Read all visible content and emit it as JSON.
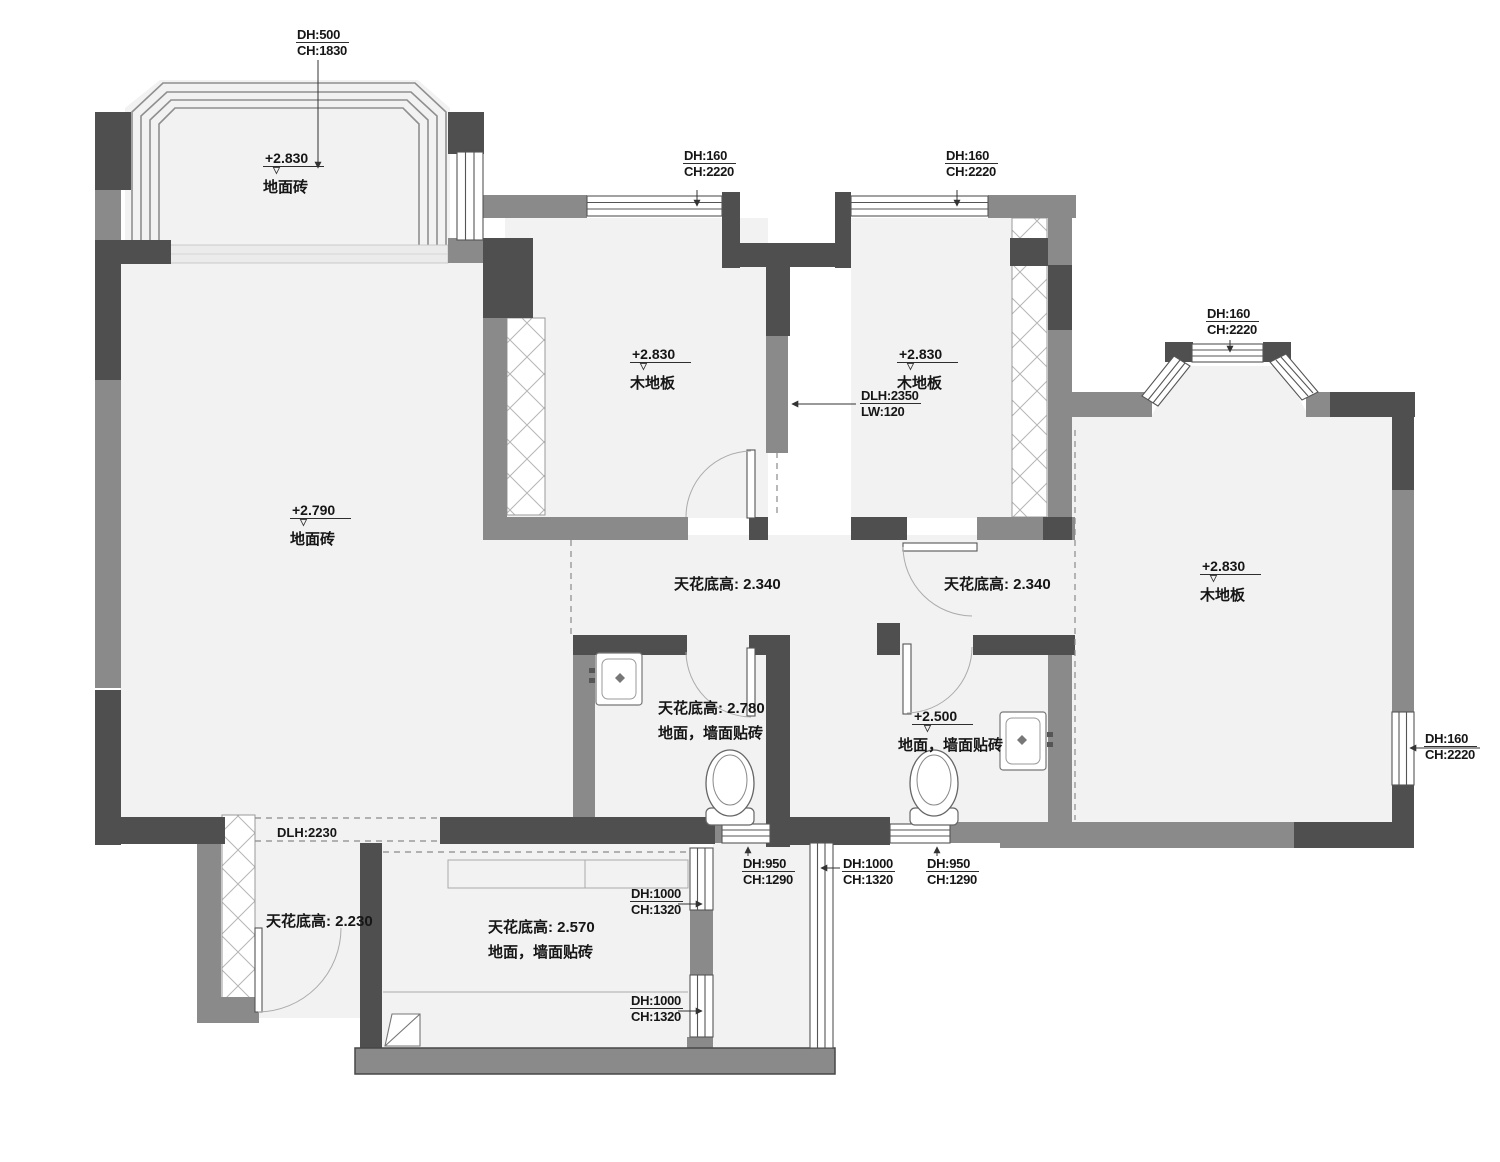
{
  "drawing": {
    "level_mark": "▽",
    "colors": {
      "wall_dark": "#4f4f4f",
      "wall_medium": "#8a8a8a",
      "room_fill": "#f2f2f2",
      "annotation": "#161616"
    },
    "labels": {
      "balcony_top_window": {
        "dh": "DH:500",
        "ch": "CH:1830"
      },
      "balcony_top_level": {
        "level": "+2.830",
        "material": "地面砖"
      },
      "living_level": {
        "level": "+2.790",
        "material": "地面砖"
      },
      "bedroom_a_window": {
        "dh": "DH:160",
        "ch": "CH:2220"
      },
      "bedroom_a_level": {
        "level": "+2.830",
        "material": "木地板"
      },
      "bedrooms_door": {
        "dlh": "DLH:2350",
        "lw": "LW:120"
      },
      "bedroom_b_window": {
        "dh": "DH:160",
        "ch": "CH:2220"
      },
      "bedroom_b_level": {
        "level": "+2.830",
        "material": "木地板"
      },
      "master_bay_window": {
        "dh": "DH:160",
        "ch": "CH:2220"
      },
      "master_level": {
        "level": "+2.830",
        "material": "木地板"
      },
      "master_side_window": {
        "dh": "DH:160",
        "ch": "CH:2220"
      },
      "hall_ceiling_left": "天花底高: 2.340",
      "hall_ceiling_right": "天花底高: 2.340",
      "bath1_ceiling": "天花底高: 2.780",
      "bath1_finish": "地面，墙面贴砖",
      "bath2_level": {
        "level": "+2.500",
        "material": "地面，墙面贴砖"
      },
      "entry_opening": "DLH:2230",
      "balcony_bottom_ceiling": "天花底高: 2.230",
      "kitchen_ceiling": "天花底高: 2.570",
      "kitchen_finish": "地面，墙面贴砖",
      "kitchen_window_1": {
        "dh": "DH:1000",
        "ch": "CH:1320"
      },
      "kitchen_window_2": {
        "dh": "DH:1000",
        "ch": "CH:1320"
      },
      "lightwell_window_left": {
        "dh": "DH:950",
        "ch": "CH:1290"
      },
      "lightwell_window_mid": {
        "dh": "DH:1000",
        "ch": "CH:1320"
      },
      "lightwell_window_right": {
        "dh": "DH:950",
        "ch": "CH:1290"
      }
    }
  }
}
